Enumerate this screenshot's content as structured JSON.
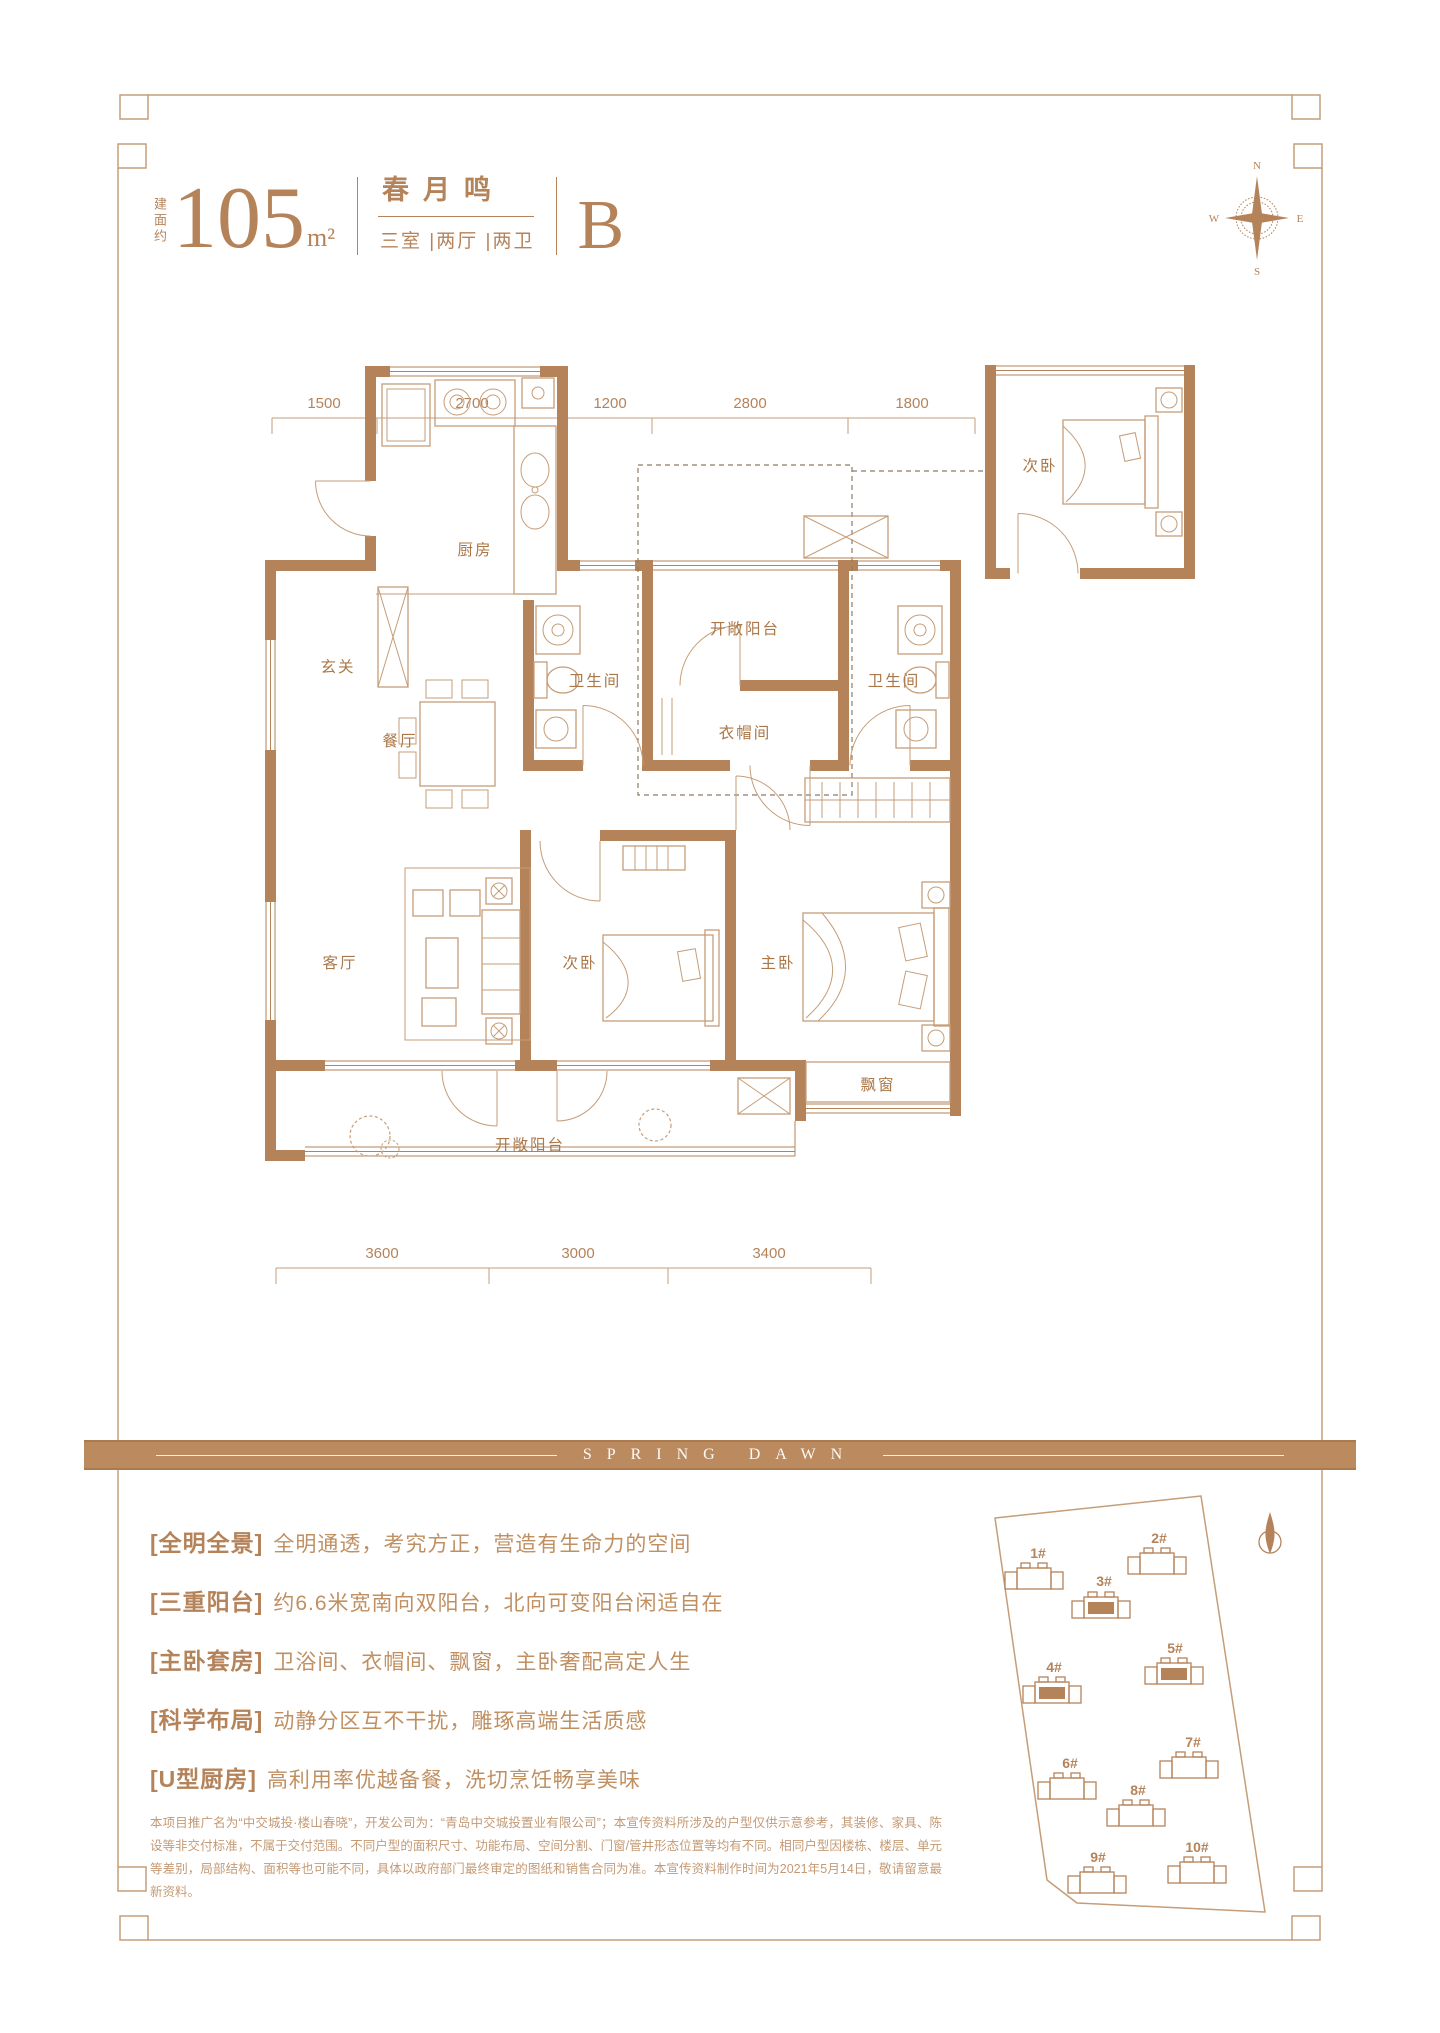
{
  "colors": {
    "accent": "#b5835a",
    "thin_line": "#c59d78",
    "banner_bg": "#bc8a5f",
    "white": "#ffffff"
  },
  "header": {
    "area_label": "建面约",
    "area_value": "105",
    "area_unit": "m²",
    "name": "春月鸣",
    "rooms_spec": "三室 |两厅 |两卫",
    "unit_code": "B"
  },
  "compass": {
    "north": "N",
    "south": "S",
    "east": "E",
    "west": "W"
  },
  "floorplan": {
    "dims_top": [
      "1500",
      "2700",
      "1200",
      "2800",
      "1800"
    ],
    "dims_bottom": [
      "3600",
      "3000",
      "3400"
    ],
    "rooms": {
      "kitchen": "厨房",
      "foyer": "玄关",
      "dining": "餐厅",
      "bath1": "卫生间",
      "north_balcony": "开敞阳台",
      "cloak": "衣帽间",
      "bath2": "卫生间",
      "bedroom_detached": "次卧",
      "living": "客厅",
      "bedroom2": "次卧",
      "master": "主卧",
      "bay_window": "飘窗",
      "south_balcony": "开敞阳台"
    }
  },
  "banner": {
    "text": "SPRING DAWN"
  },
  "features": [
    {
      "tag": "[全明全景]",
      "desc": "全明通透，考究方正，营造有生命力的空间"
    },
    {
      "tag": "[三重阳台]",
      "desc": "约6.6米宽南向双阳台，北向可变阳台闲适自在"
    },
    {
      "tag": "[主卧套房]",
      "desc": "卫浴间、衣帽间、飘窗，主卧奢配高定人生"
    },
    {
      "tag": "[科学布局]",
      "desc": "动静分区互不干扰，雕琢高端生活质感"
    },
    {
      "tag": "[U型厨房]",
      "desc": "高利用率优越备餐，洗切烹饪畅享美味"
    }
  ],
  "disclaimer": "本项目推广名为“中交城投·楼山春晓”，开发公司为：“青岛中交城投置业有限公司”；本宣传资料所涉及的户型仅供示意参考，其装修、家具、陈设等非交付标准，不属于交付范围。不同户型的面积尺寸、功能布局、空间分割、门窗/管井形态位置等均有不同。相同户型因楼栋、楼层、单元等差别，局部结构、面积等也可能不同，具体以政府部门最终审定的图纸和销售合同为准。本宣传资料制作时间为2021年5月14日，敬请留意最新资料。",
  "siteplan": {
    "buildings": [
      {
        "label": "1#",
        "highlighted": false
      },
      {
        "label": "2#",
        "highlighted": false
      },
      {
        "label": "3#",
        "highlighted": true
      },
      {
        "label": "4#",
        "highlighted": true
      },
      {
        "label": "5#",
        "highlighted": true
      },
      {
        "label": "6#",
        "highlighted": false
      },
      {
        "label": "7#",
        "highlighted": false
      },
      {
        "label": "8#",
        "highlighted": false
      },
      {
        "label": "9#",
        "highlighted": false
      },
      {
        "label": "10#",
        "highlighted": false
      }
    ]
  }
}
